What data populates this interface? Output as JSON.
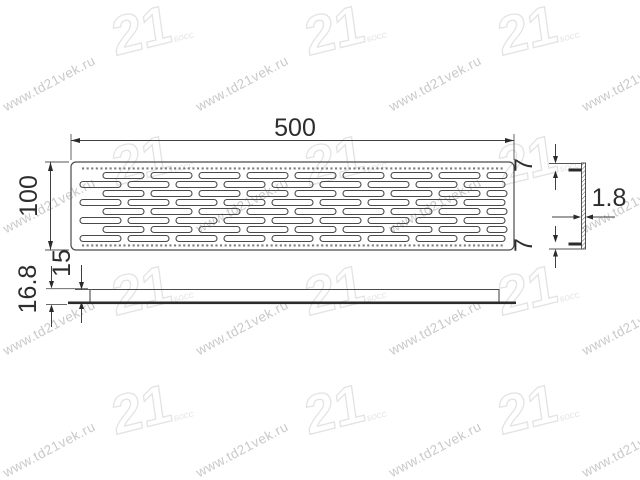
{
  "watermark": {
    "url_text": "www.td21vek.ru",
    "logo_text": "21",
    "logo_subtext": "БОСС",
    "text_color": "#c9c9c9",
    "logo_color": "#e3e3e3"
  },
  "drawing": {
    "line_color": "#3f3f3f",
    "dark_fill": "#2b2b2b",
    "dims": {
      "width": "500",
      "height": "100",
      "flange_top_inset": "7",
      "flange_bottom_inset": "7",
      "thickness": "1.8",
      "total_depth": "16.8",
      "mount_depth": "15"
    },
    "plan": {
      "rect": {
        "x": 71,
        "y": 162,
        "w": 443,
        "h": 88,
        "rx": 5
      },
      "inner_left": 80,
      "inner_right": 506,
      "slot_w": 41,
      "slot_gap": 7,
      "slot_h": 6,
      "row_y0": 175.5,
      "row_pitch": 9,
      "row_starts": [
        103,
        80,
        103,
        80,
        103,
        80,
        103,
        80
      ],
      "dot_rows_y": [
        168.5,
        245.5
      ],
      "dot_x0": 82,
      "dot_x1": 504,
      "dot_pitch": 4.6,
      "dot_size": 2.1
    }
  }
}
